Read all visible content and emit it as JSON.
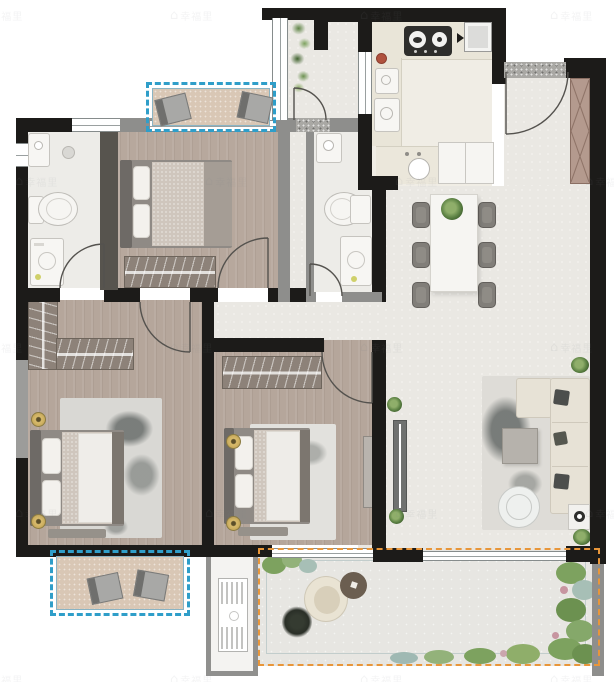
{
  "watermark": {
    "text": "幸福里",
    "icon": "house-icon"
  },
  "colors": {
    "wall": "#1c1b19",
    "wall_gray": "#8e8e8c",
    "ac_platform_dash": "#2f9ec9",
    "terrace_dash": "#e8963a",
    "wood_floor": "#b5a69b",
    "tile_floor": "#eae8e3",
    "ac_platform_floor": "#d9c7b5",
    "greenery": "#6f9a55",
    "watermark_color": "#7f858a"
  },
  "rooms": [
    {
      "name": "bathroom-top-left",
      "fixtures": [
        "vanity-sink",
        "toilet",
        "washing-machine",
        "floor-drain"
      ]
    },
    {
      "name": "bedroom-top",
      "furniture": [
        "double-bed",
        "wardrobe"
      ]
    },
    {
      "name": "service-balcony",
      "features": [
        "planter",
        "window",
        "door"
      ]
    },
    {
      "name": "kitchen",
      "fixtures": [
        "gas-cooktop",
        "refrigerator",
        "double-sink",
        "round-sink",
        "cabinet"
      ]
    },
    {
      "name": "entry-foyer",
      "furniture": [
        "shoe-cabinet"
      ],
      "features": [
        "entry-door"
      ]
    },
    {
      "name": "bathroom-middle",
      "fixtures": [
        "vanity-sink",
        "toilet",
        "washing-machine"
      ]
    },
    {
      "name": "dining-area",
      "furniture": [
        "dining-table",
        "six-chairs",
        "table-plant"
      ]
    },
    {
      "name": "living-area",
      "furniture": [
        "l-shaped-sofa",
        "coffee-table",
        "round-lounge-chair",
        "side-table",
        "tv-console",
        "area-rug"
      ]
    },
    {
      "name": "master-bedroom",
      "furniture": [
        "double-bed",
        "l-shaped-wardrobe",
        "bench",
        "area-rug",
        "bedside-lamps"
      ]
    },
    {
      "name": "bedroom-second",
      "furniture": [
        "double-bed",
        "wardrobe",
        "bench",
        "area-rug",
        "bedside-lamps"
      ]
    },
    {
      "name": "ac-platform-top",
      "equipment": [
        "ac-unit",
        "ac-unit"
      ]
    },
    {
      "name": "ac-platform-bottom-left",
      "equipment": [
        "ac-unit",
        "ac-unit"
      ]
    },
    {
      "name": "equipment-platform",
      "equipment": [
        "outdoor-ac-unit"
      ]
    },
    {
      "name": "terrace",
      "furniture": [
        "egg-chair",
        "round-table",
        "dark-plant",
        "garden-beds"
      ]
    }
  ]
}
